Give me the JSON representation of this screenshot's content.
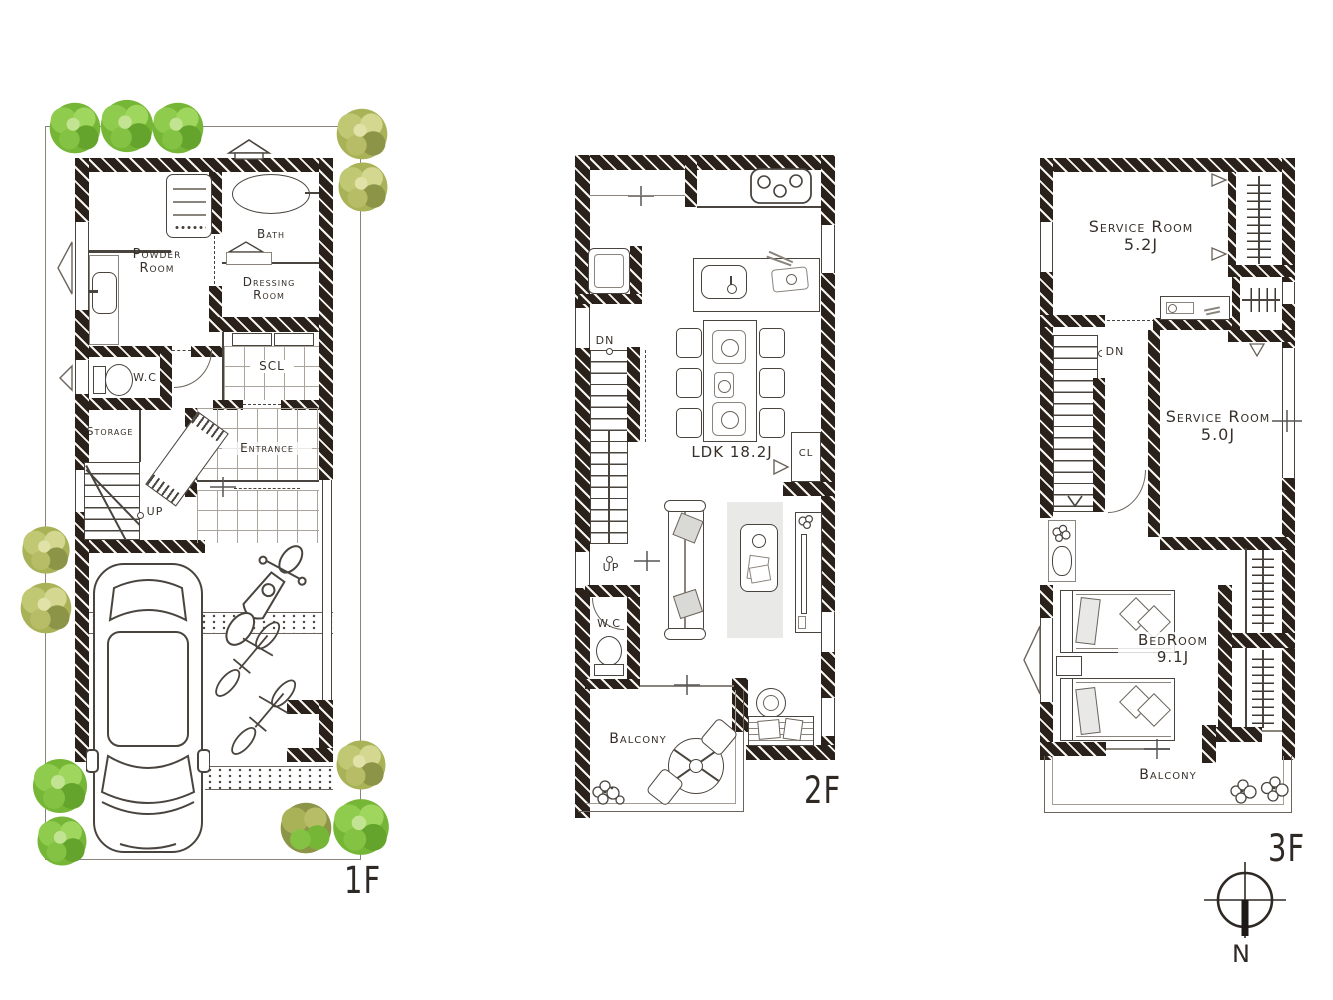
{
  "colors": {
    "wall": "#2b211b",
    "line": "#4a443e",
    "tree_green": "#76b637",
    "tree_olive": "#aab258",
    "rug": "#e9e9e7",
    "paper": "#ffffff"
  },
  "f1": {
    "tag": "1F",
    "powder1": "Powder",
    "powder2": "Room",
    "bath": "Bath",
    "dress1": "Dressing",
    "dress2": "Room",
    "wc": "W.C",
    "storage": "Storage",
    "scl": "SCL",
    "entrance": "Entrance",
    "up": "UP"
  },
  "f2": {
    "tag": "2F",
    "ldk": "LDK 18.2J",
    "dn": "DN",
    "up": "UP",
    "wc": "W.C",
    "cl": "CL",
    "balcony": "Balcony"
  },
  "f3": {
    "tag": "3F",
    "sr1a": "Service Room",
    "sr1b": "5.2J",
    "sr2a": "Service Room",
    "sr2b": "5.0J",
    "dn": "DN",
    "bed1": "BedRoom",
    "bed2": "9.1J",
    "balcony": "Balcony"
  },
  "compass": {
    "n": "N"
  }
}
